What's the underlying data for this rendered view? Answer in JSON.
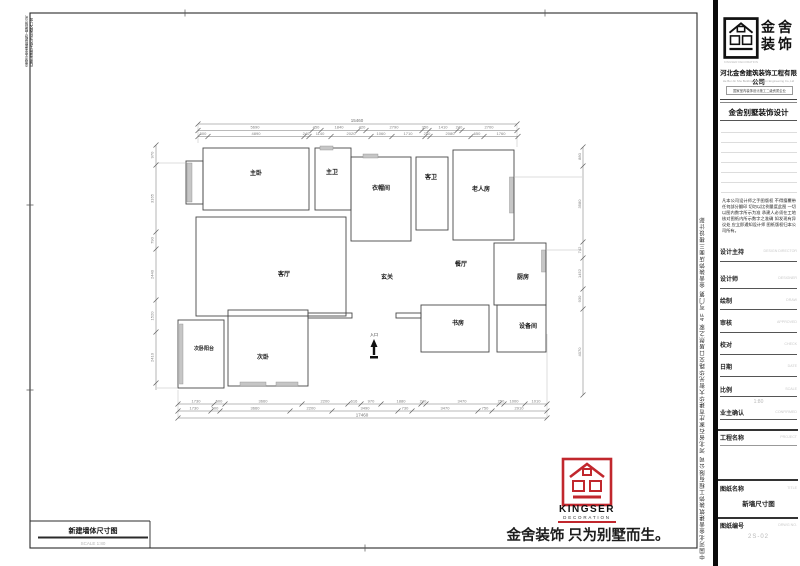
{
  "sheet": {
    "slogan": "金舍装饰 只为别墅而生。",
    "bottom_title": {
      "label": "新建墙体尺寸图",
      "scale": "SCALE 1:80"
    },
    "side_vertical_text": "中国河北金舍建筑装饰工程有限公司 河北省石家庄市建华大街光华路交口居然之家 4F 写门第 金舍装饰店面三楼设计部",
    "left_edge_vertical_text": "中国河北金舍建筑装饰工程有限公司 石家庄市建华大街与光华路交口 金舍装饰设计部"
  },
  "kingser_logo": {
    "name": "KINGSER",
    "sub": "DECORATION",
    "color": "#C1272D"
  },
  "panel": {
    "brand": {
      "line1": "金舍",
      "line2": "装饰",
      "tiny": "KINGSER DECORATION"
    },
    "company": "河北金舍建筑装饰工程有限公司",
    "company_en": "He Bei Jin She Building Decoration Engineering Co.,Ltd",
    "cert": "国家室内装饰设计施工二级资质企业",
    "dept": "金舍别墅装饰设计",
    "notice": "凡本公司设计师之手图版权 不得擅覆带任何部分翻印 切勿以比例量度此图 一切以图内数字所示为准 承建人必须在工地核对图纸内所示数字之准确 如发现有异议处 应立即通知设计师 图纸版权归本公司所有。",
    "fields": [
      {
        "label": "设计主持",
        "en": "DESIGN DIRECTOR",
        "value": ""
      },
      {
        "label": "设计师",
        "en": "DESIGNER",
        "value": ""
      },
      {
        "label": "绘制",
        "en": "DRAW",
        "value": ""
      },
      {
        "label": "审核",
        "en": "APPROVED",
        "value": ""
      },
      {
        "label": "校对",
        "en": "CHECK",
        "value": ""
      },
      {
        "label": "日期",
        "en": "DATE",
        "value": ""
      },
      {
        "label": "比例",
        "en": "SCALE",
        "value": "1:80"
      },
      {
        "label": "业主确认",
        "en": "CONFIRMED",
        "value": ""
      },
      {
        "label": "工程名称",
        "en": "PROJECT",
        "value": ""
      },
      {
        "label": "图纸名称",
        "en": "TITLE",
        "value": "新墙尺寸图"
      },
      {
        "label": "图纸编号",
        "en": "DRWG NO.",
        "value": "2S-02"
      }
    ]
  },
  "plan": {
    "rooms": [
      "主卧",
      "主卫",
      "衣帽间",
      "客卫",
      "老人房",
      "客厅",
      "玄关",
      "餐厅",
      "厨房",
      "书房",
      "设备间",
      "次卧",
      "次卧阳台"
    ],
    "entrance_label": "入口",
    "dims": {
      "top_total": "15460",
      "top_mid": [
        "5690",
        "450",
        "1840",
        "420",
        "2790",
        "350",
        "1410",
        "240",
        "2700"
      ],
      "top_detail": [
        "500",
        "4890",
        "240",
        "1140",
        "2020",
        "1060",
        "1710",
        "240",
        "2080",
        "650",
        "1760"
      ],
      "bottom_detail": [
        "1730",
        "500",
        "3660",
        "2200",
        "616",
        "970",
        "1880",
        "240",
        "3470",
        "250",
        "1000",
        "1010"
      ],
      "bottom_mid": [
        "1730",
        "500",
        "3660",
        "2200",
        "3490",
        "730",
        "3470",
        "750",
        "2910"
      ],
      "bottom_total": "17460",
      "left": [
        "970",
        "3165",
        "790",
        "2440",
        "1520",
        "2410"
      ],
      "right": [
        "880",
        "3580",
        "742",
        "1452",
        "930",
        "4070"
      ]
    }
  }
}
